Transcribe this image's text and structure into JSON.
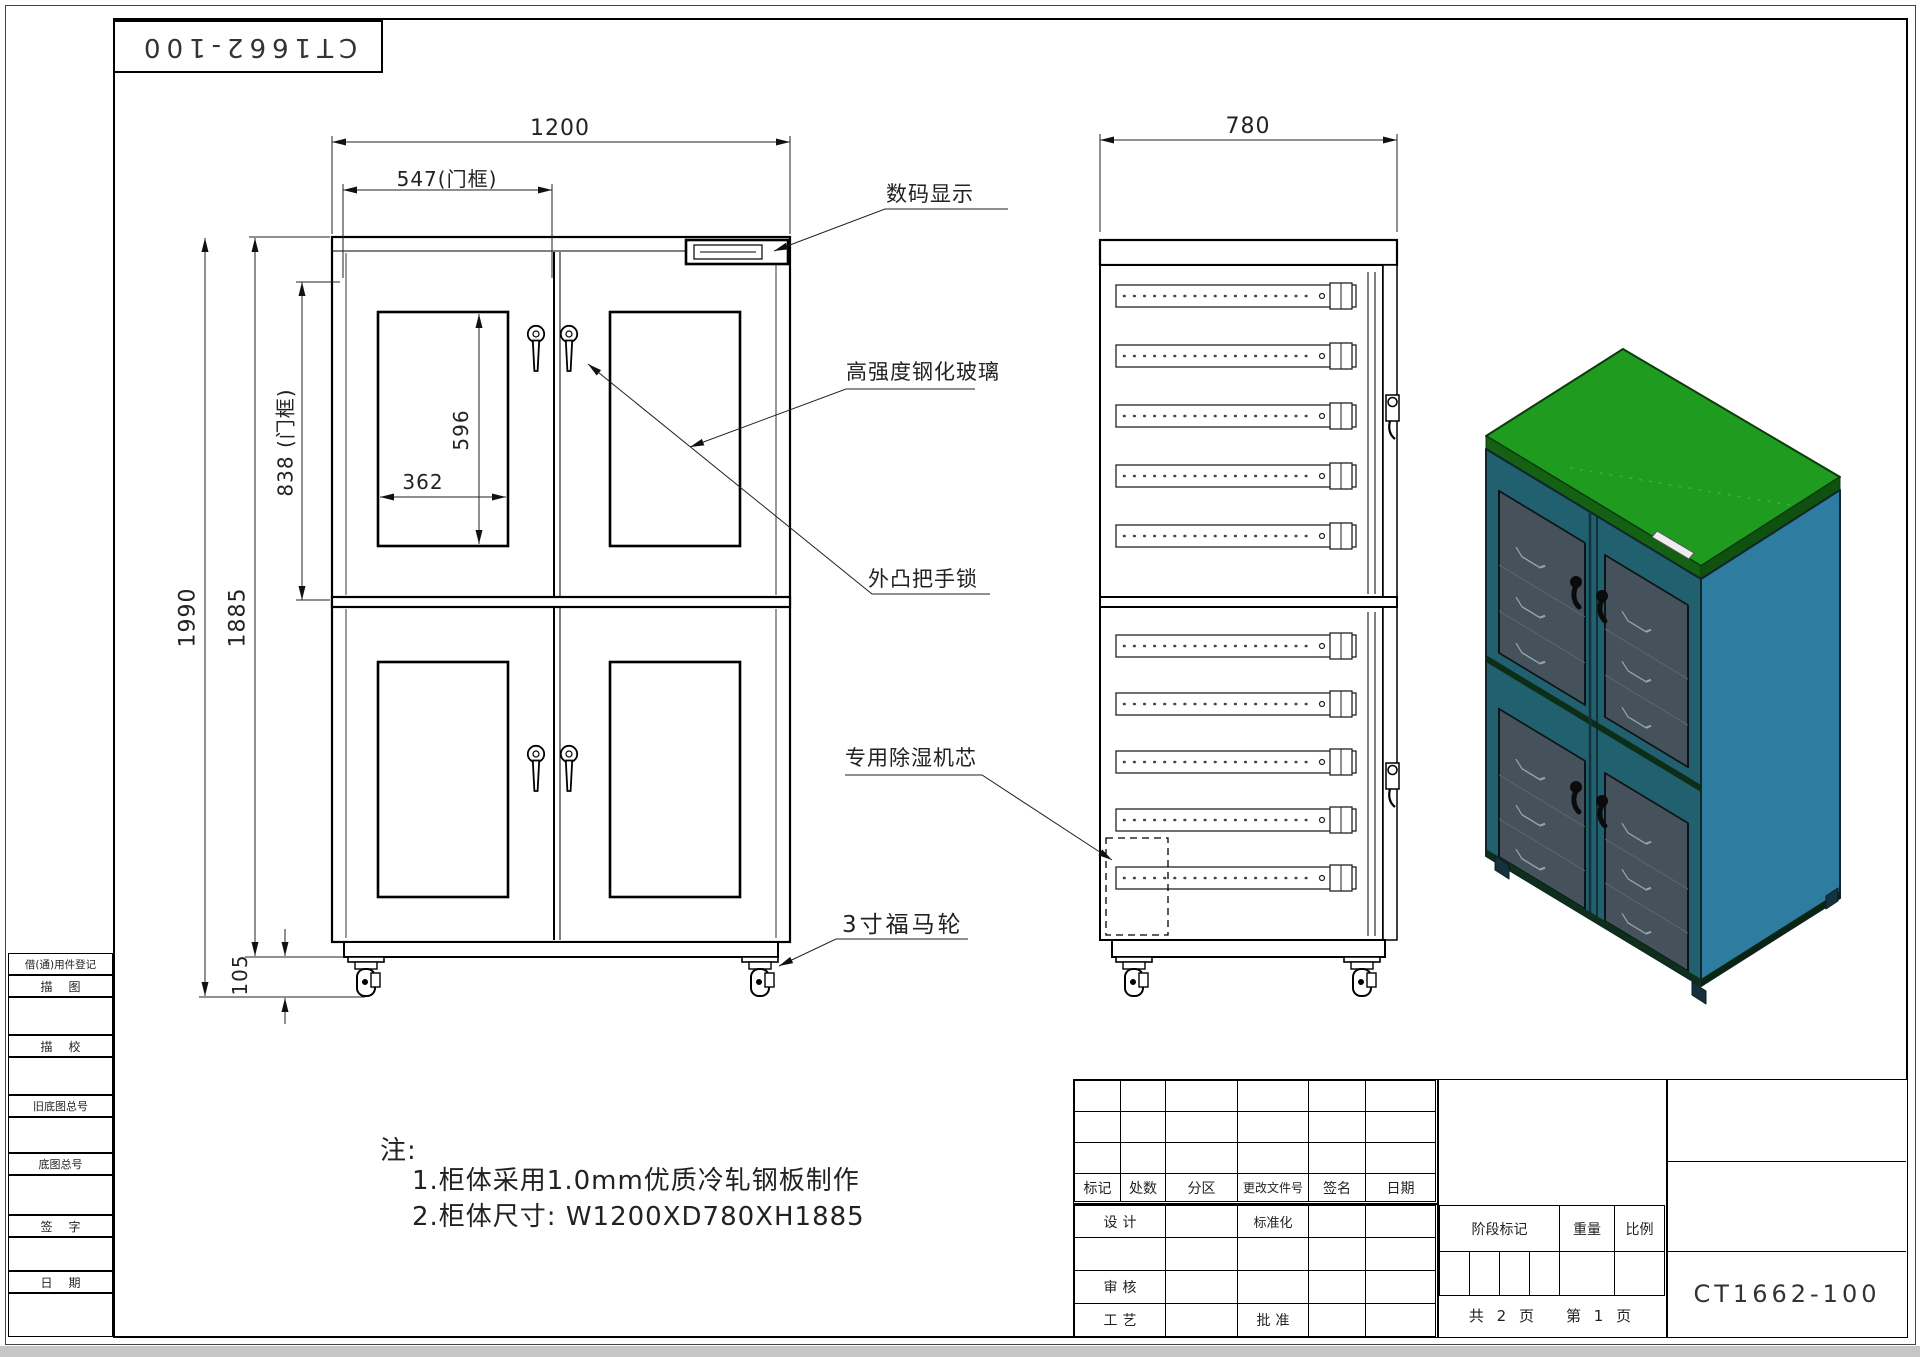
{
  "title_top": "CT1662-100",
  "front": {
    "dim_width": "1200",
    "dim_door_width": "547(门框)",
    "dim_glass_h": "596",
    "dim_glass_w": "362",
    "dim_door_h": "838 (门框)",
    "dim_total_h": "1990",
    "dim_body_h": "1885",
    "dim_caster_h": "105",
    "callout_display": "数码显示",
    "callout_glass": "高强度钢化玻璃",
    "callout_lock": "外凸把手锁",
    "callout_caster": "3寸福马轮"
  },
  "side": {
    "dim_depth": "780",
    "callout_dehumidifier": "专用除湿机芯"
  },
  "notes": {
    "heading": "注:",
    "line1": "1.柜体采用1.0mm优质冷轧钢板制作",
    "line2": "2.柜体尺寸: W1200XD780XH1885"
  },
  "margin_fields": {
    "reuse_record": "借(通)用件登记",
    "tracing": "描图",
    "tracing_check": "描校",
    "old_master_no": "旧底图总号",
    "master_no": "底图总号",
    "signature": "签字",
    "date": "日期"
  },
  "title_block": {
    "rev_mark": "标记",
    "rev_count": "处数",
    "rev_zone": "分区",
    "rev_doc_no": "更改文件号",
    "rev_sign": "签名",
    "rev_date": "日期",
    "design": "设计",
    "standardization": "标准化",
    "check": "审核",
    "process": "工艺",
    "approve": "批准",
    "stage_mark": "阶段标记",
    "weight": "重量",
    "scale": "比例",
    "sheet_total": "共 2 页",
    "sheet_current": "第 1 页",
    "drawing_no": "CT1662-100"
  },
  "colors": {
    "top_face": "#1f9b1f",
    "top_rim": "#146114",
    "side_face": "#2e7ca0",
    "front_face": "#20606f",
    "glass": "#46525b"
  }
}
